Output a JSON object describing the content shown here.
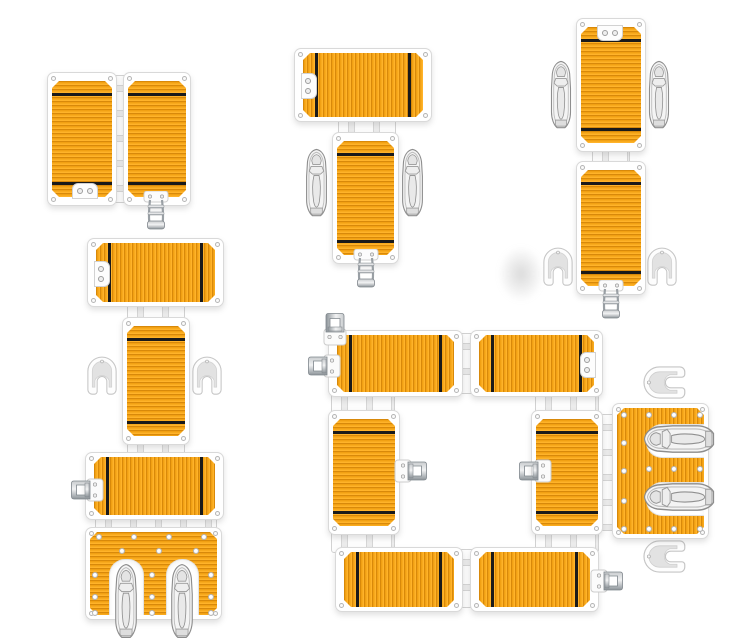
{
  "meta": {
    "description": "Product illustration: modular floating dock platforms shown in five assembly configurations with jet skis",
    "background": "#ffffff"
  },
  "colors": {
    "background": "#ffffff",
    "deck_base": "#f1a013",
    "deck_rib_dark": "#d8890a",
    "deck_rib_light": "#ffb32a",
    "deck_stripe": "#1a1a1a",
    "frame_white": "#ffffff",
    "frame_border": "#d9d9d9",
    "connector_fill": "#f4f4f4",
    "connector_line": "#d2d2d2",
    "screw_ring": "#b5b5b5",
    "hull_fill": "#f4f4f4",
    "hull_line": "#8d8d8d",
    "hook_fill": "#fdfdfd",
    "hook_inner": "#e2e2e2",
    "metal_light": "#eceeef",
    "metal_dark": "#8d9499"
  },
  "configurations": [
    {
      "id": "dock-two-wide",
      "label": "Two dock platforms joined side by side with latch"
    },
    {
      "id": "dock-t-shape",
      "label": "T-shape dock with two jet skis moored alongside and boarding latch"
    },
    {
      "id": "dock-two-long",
      "label": "Two platforms joined end to end with jet skis and mooring hooks"
    },
    {
      "id": "dock-chain-ramp",
      "label": "Straight dock chain with hooks and twin jet ski drive-on ramp"
    },
    {
      "id": "dock-square-ring",
      "label": "Square ring dock with latches and twin jet ski drive-on ramp"
    }
  ],
  "counts": {
    "platforms": 15,
    "jet_skis": 8,
    "mooring_hooks": 6,
    "latches": 9
  }
}
